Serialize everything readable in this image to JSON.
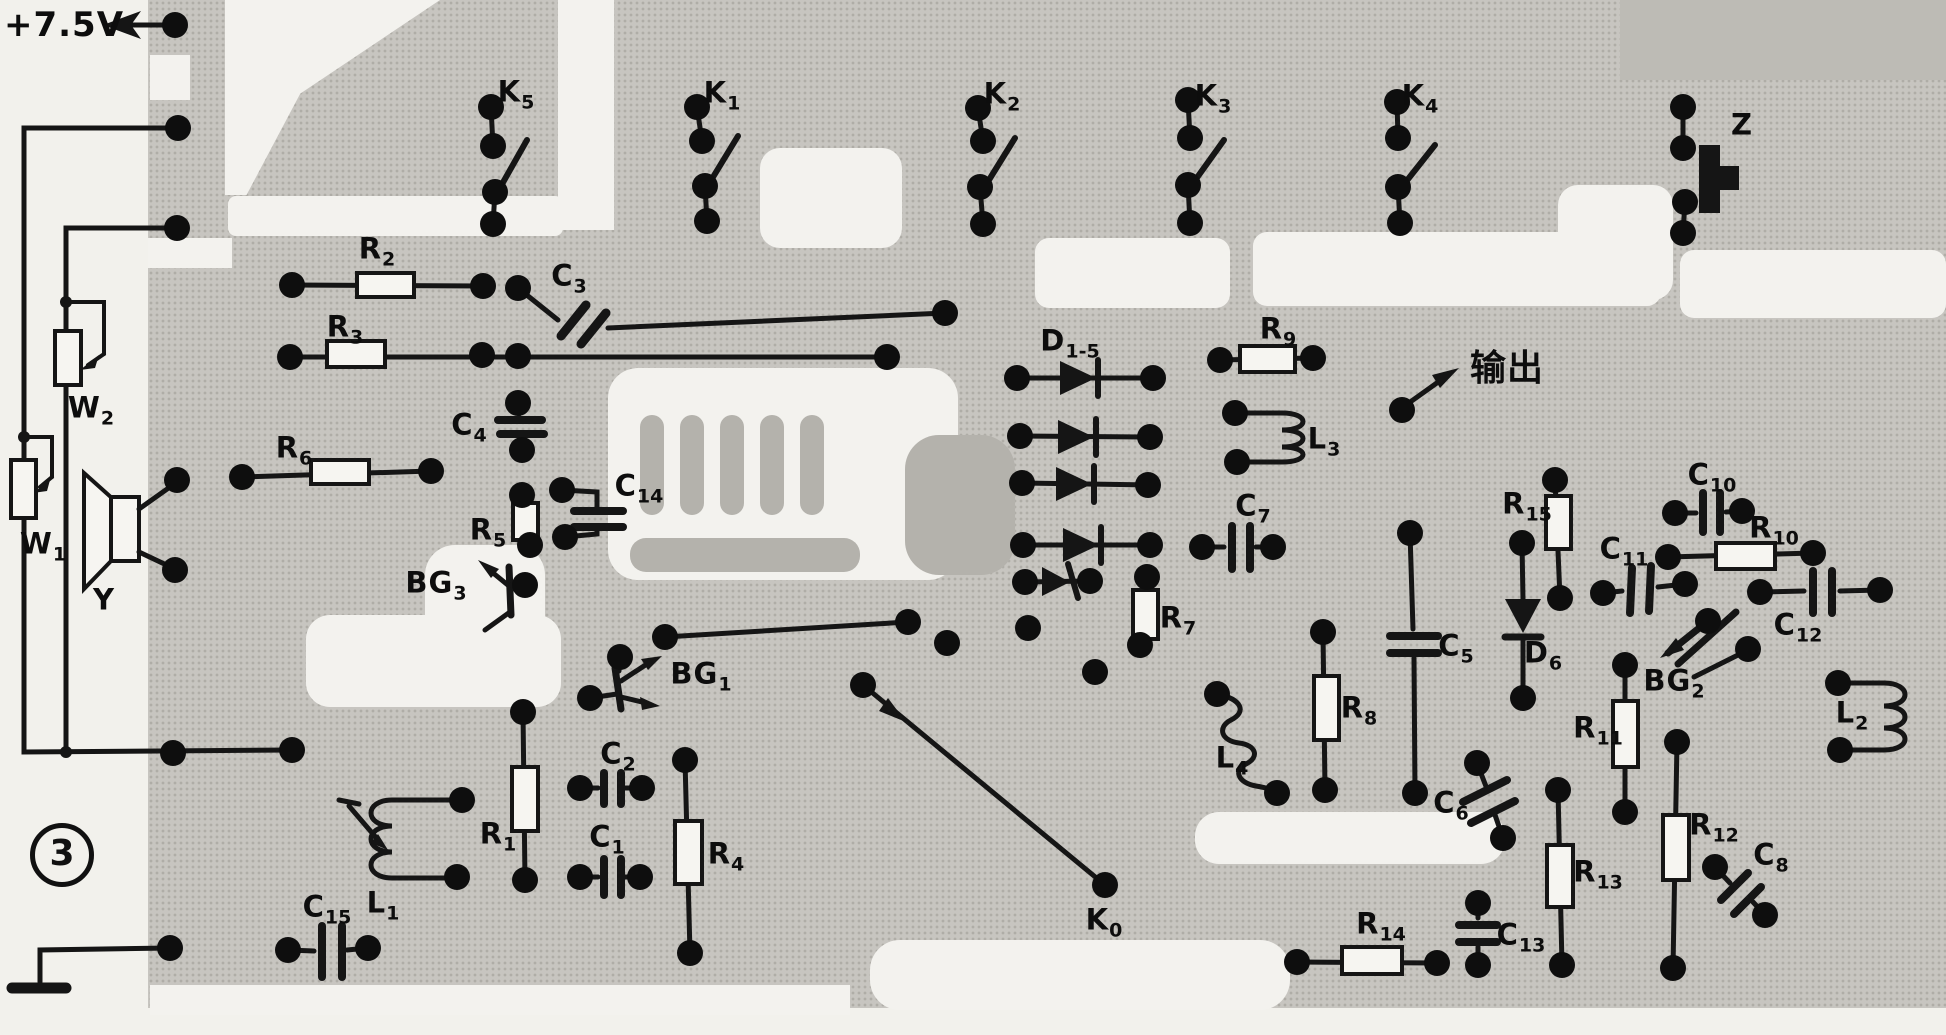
{
  "figure": {
    "power_label": "+7.5V",
    "output_label": "输出",
    "figure_number": "3"
  },
  "components": {
    "K0": {
      "main": "K",
      "sub": "0"
    },
    "K1": {
      "main": "K",
      "sub": "1"
    },
    "K2": {
      "main": "K",
      "sub": "2"
    },
    "K3": {
      "main": "K",
      "sub": "3"
    },
    "K4": {
      "main": "K",
      "sub": "4"
    },
    "K5": {
      "main": "K",
      "sub": "5"
    },
    "Z": {
      "main": "Z",
      "sub": ""
    },
    "R1": {
      "main": "R",
      "sub": "1"
    },
    "R2": {
      "main": "R",
      "sub": "2"
    },
    "R3": {
      "main": "R",
      "sub": "3"
    },
    "R4": {
      "main": "R",
      "sub": "4"
    },
    "R5": {
      "main": "R",
      "sub": "5"
    },
    "R6": {
      "main": "R",
      "sub": "6"
    },
    "R7": {
      "main": "R",
      "sub": "7"
    },
    "R8": {
      "main": "R",
      "sub": "8"
    },
    "R9": {
      "main": "R",
      "sub": "9"
    },
    "R10": {
      "main": "R",
      "sub": "10"
    },
    "R11": {
      "main": "R",
      "sub": "11"
    },
    "R12": {
      "main": "R",
      "sub": "12"
    },
    "R13": {
      "main": "R",
      "sub": "13"
    },
    "R14": {
      "main": "R",
      "sub": "14"
    },
    "R15": {
      "main": "R",
      "sub": "15"
    },
    "C1": {
      "main": "C",
      "sub": "1"
    },
    "C2": {
      "main": "C",
      "sub": "2"
    },
    "C3": {
      "main": "C",
      "sub": "3"
    },
    "C4": {
      "main": "C",
      "sub": "4"
    },
    "C5": {
      "main": "C",
      "sub": "5"
    },
    "C6": {
      "main": "C",
      "sub": "6"
    },
    "C7": {
      "main": "C",
      "sub": "7"
    },
    "C8": {
      "main": "C",
      "sub": "8"
    },
    "C10": {
      "main": "C",
      "sub": "10"
    },
    "C11": {
      "main": "C",
      "sub": "11"
    },
    "C12": {
      "main": "C",
      "sub": "12"
    },
    "C13": {
      "main": "C",
      "sub": "13"
    },
    "C14": {
      "main": "C",
      "sub": "14"
    },
    "C15": {
      "main": "C",
      "sub": "15"
    },
    "D1_5": {
      "main": "D",
      "sub": "1-5"
    },
    "D6": {
      "main": "D",
      "sub": "6"
    },
    "BG1": {
      "main": "BG",
      "sub": "1"
    },
    "BG2": {
      "main": "BG",
      "sub": "2"
    },
    "BG3": {
      "main": "BG",
      "sub": "3"
    },
    "W1": {
      "main": "W",
      "sub": "1"
    },
    "W2": {
      "main": "W",
      "sub": "2"
    },
    "Y": {
      "main": "Y",
      "sub": ""
    },
    "L1": {
      "main": "L",
      "sub": "1"
    },
    "L2": {
      "main": "L",
      "sub": "2"
    },
    "L3": {
      "main": "L",
      "sub": "3"
    },
    "L4": {
      "main": "L",
      "sub": "4"
    }
  }
}
